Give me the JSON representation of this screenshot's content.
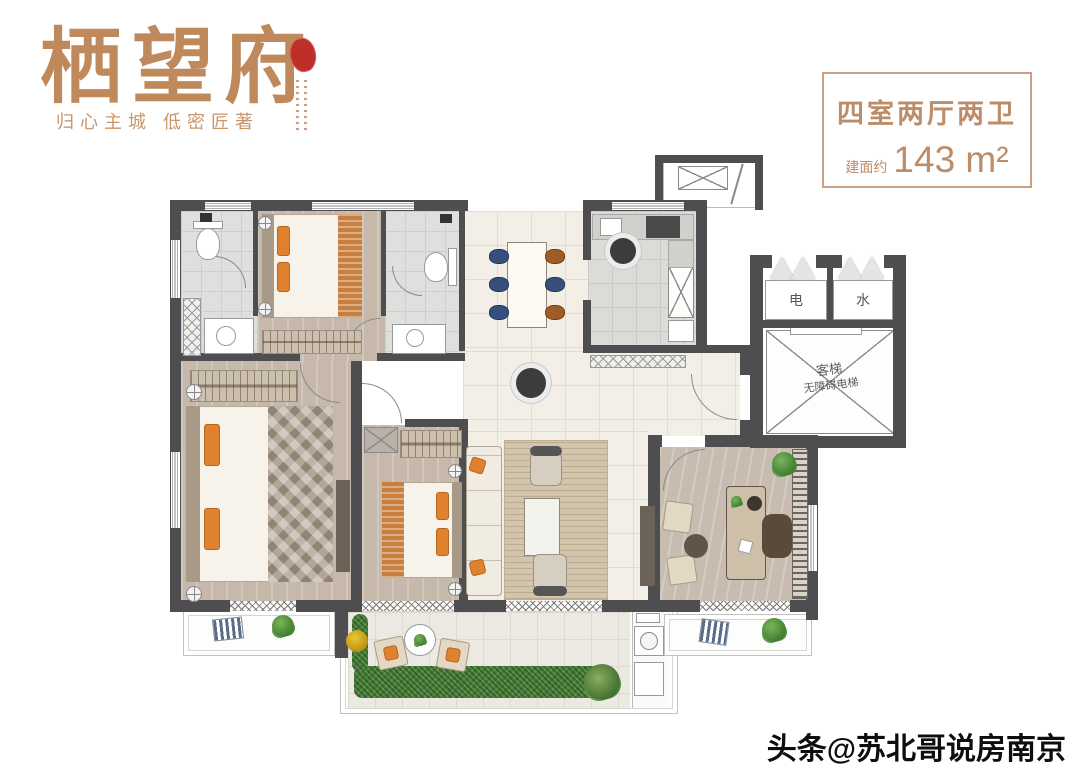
{
  "brand": {
    "title": "栖望府",
    "tagline": "归心主城  低密匠著"
  },
  "info_box": {
    "rooms": "四室两厅两卫",
    "area_prefix": "建面约",
    "area_value": "143 m²"
  },
  "plan": {
    "labels": {
      "electric": "电",
      "water": "水",
      "elevator_name": "客梯",
      "elevator_type": "无障碍电梯"
    }
  },
  "watermark": {
    "text": "头条@苏北哥说房南京"
  },
  "colors": {
    "brand_tan": "#c0895c",
    "info_border": "#cb9f7f",
    "wall_gray": "#4e4e50",
    "accent_orange": "#e0812f",
    "accent_navy": "#35507c",
    "plant_green": "#4a8539",
    "seal_red": "#bf2f2a",
    "watermark_black": "#0e0e0e"
  }
}
